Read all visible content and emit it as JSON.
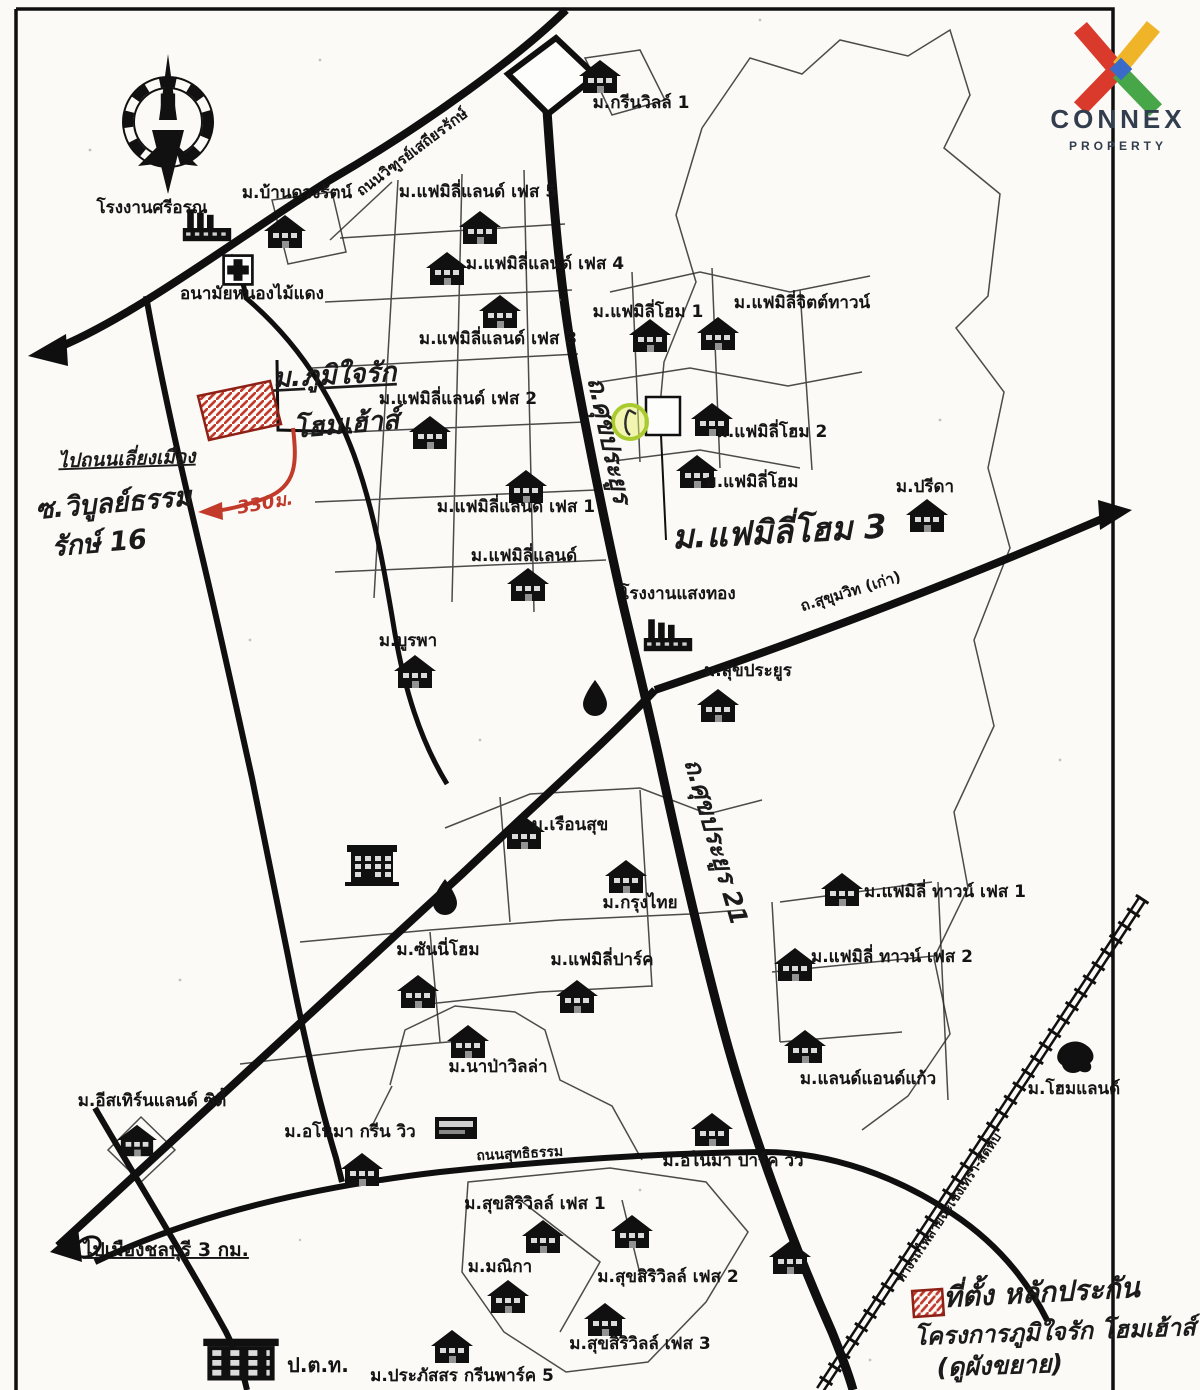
{
  "logo": {
    "brand": "CONNEX",
    "sub": "PROPERTY",
    "colors": {
      "red": "#d93a2b",
      "yellow": "#f0b429",
      "green": "#47a647",
      "blue": "#3a6bc9",
      "navy": "#323d4d"
    }
  },
  "compass": {
    "north_label": "N"
  },
  "legend": {
    "marker_color": "#c0392b",
    "lines": [
      "ที่ตั้ง หลักประกัน",
      "โครงการภูมิใจรัก โฮมเฮ้าส์",
      "(ดูผังขยาย)"
    ]
  },
  "map": {
    "place_labels": [
      {
        "t": "โรงงานศรีอรุณ",
        "x": 152,
        "y": 213
      },
      {
        "t": "ม.บ้านดวงรัตน์",
        "x": 297,
        "y": 198
      },
      {
        "t": "อนามัยหนองไม้แดง",
        "x": 252,
        "y": 299
      },
      {
        "t": "ม.กรีนวิลล์ 1",
        "x": 641,
        "y": 108
      },
      {
        "t": "ม.แฟมิลี่แลนด์ เฟส 5",
        "x": 478,
        "y": 197
      },
      {
        "t": "ม.แฟมิลี่แลนด์ เฟส 4",
        "x": 545,
        "y": 269
      },
      {
        "t": "ม.แฟมิลี่แลนด์ เฟส 3",
        "x": 498,
        "y": 344
      },
      {
        "t": "ม.แฟมิลี่โฮม 1",
        "x": 648,
        "y": 317
      },
      {
        "t": "ม.แฟมิลี่จิตต์ทาวน์",
        "x": 802,
        "y": 308
      },
      {
        "t": "ม.แฟมิลี่แลนด์ เฟส 2",
        "x": 458,
        "y": 404
      },
      {
        "t": "ม.แฟมิลี่โฮม 2",
        "x": 772,
        "y": 437
      },
      {
        "t": "ม.แฟมิลี่โฮม",
        "x": 752,
        "y": 487
      },
      {
        "t": "ม.แฟมิลี่แลนด์ เฟส 1",
        "x": 516,
        "y": 512
      },
      {
        "t": "ม.แฟมิลี่แลนด์",
        "x": 524,
        "y": 561
      },
      {
        "t": "ม.ปรีดา",
        "x": 925,
        "y": 492
      },
      {
        "t": "โรงงานแสงทอง",
        "x": 678,
        "y": 599
      },
      {
        "t": "ม.สุขประยูร",
        "x": 748,
        "y": 676
      },
      {
        "t": "ม.บูรพา",
        "x": 408,
        "y": 646
      },
      {
        "t": "ม.เรือนสุข",
        "x": 570,
        "y": 830
      },
      {
        "t": "ม.กรุงไทย",
        "x": 640,
        "y": 908
      },
      {
        "t": "ม.แฟมิลี่ ทาวน์ เฟส 1",
        "x": 945,
        "y": 897
      },
      {
        "t": "ม.แฟมิลี่ ทาวน์ เฟส 2",
        "x": 892,
        "y": 962
      },
      {
        "t": "ม.ซันนี่โฮม",
        "x": 438,
        "y": 955
      },
      {
        "t": "ม.แฟมิลี่ปาร์ค",
        "x": 602,
        "y": 965
      },
      {
        "t": "ม.นาป่าวิลล่า",
        "x": 498,
        "y": 1072
      },
      {
        "t": "ม.แลนด์แอนด์แก้ว",
        "x": 868,
        "y": 1084
      },
      {
        "t": "ม.โฮมแลนด์",
        "x": 1074,
        "y": 1094
      },
      {
        "t": "ม.อีสเทิร์นแลนด์ ซิตี้",
        "x": 152,
        "y": 1106
      },
      {
        "t": "ม.อโนมา กรีน วิว",
        "x": 350,
        "y": 1137
      },
      {
        "t": "ม.อโนมา ปาร์ค วิว",
        "x": 733,
        "y": 1166
      },
      {
        "t": "ม.สุขสิริวิลล์ เฟส 1",
        "x": 535,
        "y": 1209
      },
      {
        "t": "ม.มณิกา",
        "x": 500,
        "y": 1272
      },
      {
        "t": "ม.สุขสิริวิลล์ เฟส 2",
        "x": 668,
        "y": 1282
      },
      {
        "t": "ม.สุขสิริวิลล์ เฟส 3",
        "x": 640,
        "y": 1349
      },
      {
        "t": "ม.ประภัสสร กรีนพาร์ค 5",
        "x": 462,
        "y": 1381
      },
      {
        "t": "ป.ต.ท.",
        "x": 318,
        "y": 1372,
        "s": 20
      },
      {
        "t": "ไปเมืองชลบุรี 3 กม.",
        "x": 166,
        "y": 1256,
        "s": 19,
        "c": "u"
      }
    ],
    "road_labels": [
      {
        "t": "ถนนวิฑูรย์เสถียรรักษ์",
        "x": 415,
        "y": 156,
        "r": -37,
        "s": 15,
        "n": "road-label-bypass"
      },
      {
        "t": "ถ.ศุขประยูร",
        "x": 601,
        "y": 442,
        "r": 78,
        "s": 25,
        "c": "hand",
        "n": "road-label-sukprayoon-upper"
      },
      {
        "t": "ถ.ศุขประยูร 21",
        "x": 708,
        "y": 844,
        "r": 74,
        "s": 25,
        "c": "hand",
        "n": "road-label-sukprayoon-21"
      },
      {
        "t": "ถ.สุขุมวิท (เก่า)",
        "x": 852,
        "y": 596,
        "r": -17,
        "s": 15,
        "n": "road-label-old-sukhumvit"
      },
      {
        "t": "ถนนสุทธิธรรม",
        "x": 520,
        "y": 1158,
        "r": -3,
        "s": 14,
        "n": "road-label-suthitham"
      },
      {
        "t": "ทางรถไฟสายฉะเชิงเทรา-สัตหีบ",
        "x": 952,
        "y": 1210,
        "r": -56,
        "s": 13,
        "n": "railway-label"
      }
    ],
    "annotations": [
      {
        "t": "ม.ภูมิใจรัก",
        "x": 335,
        "y": 384,
        "s": 27,
        "c": "u",
        "r": -3,
        "n": "project-name-line1"
      },
      {
        "t": "โฮมเฮ้าส์",
        "x": 347,
        "y": 433,
        "s": 27,
        "r": -5,
        "n": "project-name-line2"
      },
      {
        "t": "ไปถนนเลี่ยงเมือง",
        "x": 127,
        "y": 465,
        "s": 19,
        "c": "u",
        "r": -2,
        "n": "to-bypass-note"
      },
      {
        "t": "ซ.วิบูลย์ธรรม",
        "x": 114,
        "y": 512,
        "s": 27,
        "r": -5,
        "n": "soi-name-line1"
      },
      {
        "t": "รักษ์ 16",
        "x": 100,
        "y": 552,
        "s": 27,
        "r": -5,
        "n": "soi-name-line2"
      },
      {
        "t": "330ม.",
        "x": 266,
        "y": 509,
        "s": 18,
        "c": "red",
        "r": -10,
        "n": "distance-note"
      },
      {
        "t": "ม.แฟมิลี่โฮม 3",
        "x": 780,
        "y": 543,
        "s": 33,
        "r": -3,
        "n": "family-home-3-note"
      }
    ],
    "legend_labels": [
      {
        "t": "ที่ตั้ง หลักประกัน",
        "x": 1042,
        "y": 1302,
        "s": 28,
        "r": -3,
        "n": "legend-line-1"
      },
      {
        "t": "โครงการภูมิใจรัก โฮมเฮ้าส์",
        "x": 1055,
        "y": 1340,
        "s": 24,
        "r": -2,
        "n": "legend-line-2"
      },
      {
        "t": "(ดูผังขยาย)",
        "x": 1000,
        "y": 1374,
        "s": 25,
        "r": -2,
        "n": "legend-line-3"
      }
    ],
    "icons": [
      {
        "k": "factory",
        "x": 207,
        "y": 228,
        "s": 1.1
      },
      {
        "k": "house",
        "x": 285,
        "y": 232
      },
      {
        "k": "cross",
        "x": 238,
        "y": 270,
        "s": 0.9
      },
      {
        "k": "house",
        "x": 600,
        "y": 77
      },
      {
        "k": "house",
        "x": 480,
        "y": 228
      },
      {
        "k": "house",
        "x": 447,
        "y": 269
      },
      {
        "k": "house",
        "x": 500,
        "y": 312
      },
      {
        "k": "house",
        "x": 650,
        "y": 336
      },
      {
        "k": "house",
        "x": 718,
        "y": 334
      },
      {
        "k": "house",
        "x": 430,
        "y": 433
      },
      {
        "k": "house",
        "x": 712,
        "y": 420
      },
      {
        "k": "house",
        "x": 697,
        "y": 472
      },
      {
        "k": "house",
        "x": 526,
        "y": 487
      },
      {
        "k": "house",
        "x": 528,
        "y": 585
      },
      {
        "k": "house",
        "x": 927,
        "y": 516
      },
      {
        "k": "factory",
        "x": 668,
        "y": 638,
        "s": 1.1
      },
      {
        "k": "house",
        "x": 718,
        "y": 706
      },
      {
        "k": "house",
        "x": 415,
        "y": 672
      },
      {
        "k": "drop",
        "x": 595,
        "y": 698,
        "s": 1.2
      },
      {
        "k": "school",
        "x": 372,
        "y": 866
      },
      {
        "k": "house",
        "x": 524,
        "y": 833
      },
      {
        "k": "drop",
        "x": 445,
        "y": 897,
        "s": 1.2
      },
      {
        "k": "house",
        "x": 626,
        "y": 877
      },
      {
        "k": "house",
        "x": 842,
        "y": 890
      },
      {
        "k": "house",
        "x": 795,
        "y": 965
      },
      {
        "k": "house",
        "x": 418,
        "y": 992
      },
      {
        "k": "house",
        "x": 577,
        "y": 997
      },
      {
        "k": "house",
        "x": 468,
        "y": 1042
      },
      {
        "k": "house",
        "x": 805,
        "y": 1047
      },
      {
        "k": "blob",
        "x": 1076,
        "y": 1057
      },
      {
        "k": "house",
        "x": 137,
        "y": 1141,
        "s": 0.95
      },
      {
        "k": "sign",
        "x": 456,
        "y": 1128
      },
      {
        "k": "house",
        "x": 362,
        "y": 1170
      },
      {
        "k": "house",
        "x": 712,
        "y": 1130
      },
      {
        "k": "house",
        "x": 543,
        "y": 1237
      },
      {
        "k": "house",
        "x": 632,
        "y": 1232
      },
      {
        "k": "house",
        "x": 508,
        "y": 1297
      },
      {
        "k": "house",
        "x": 605,
        "y": 1320
      },
      {
        "k": "house",
        "x": 452,
        "y": 1347
      },
      {
        "k": "house",
        "x": 790,
        "y": 1258
      },
      {
        "k": "ptt",
        "x": 241,
        "y": 1360,
        "s": 0.82
      }
    ]
  }
}
